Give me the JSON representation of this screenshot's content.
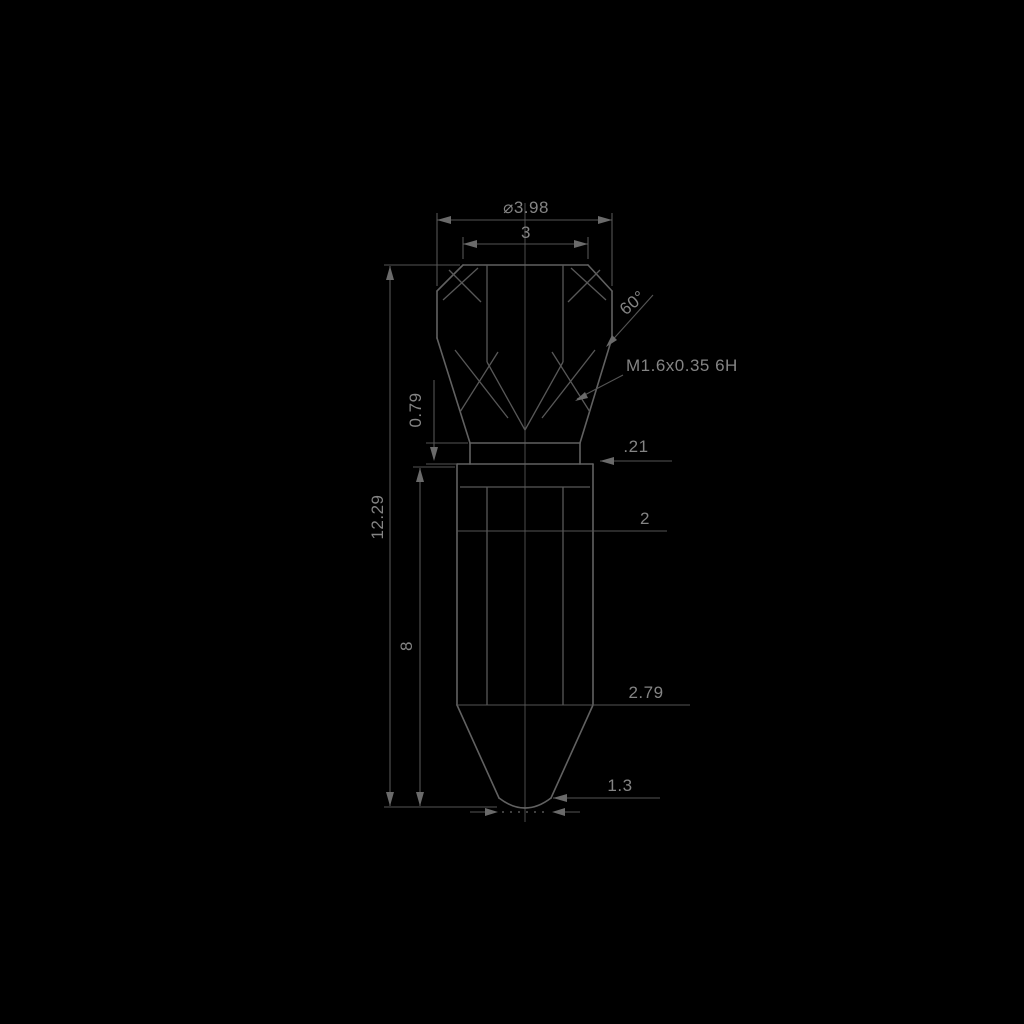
{
  "drawing": {
    "type": "engineering-dimension-drawing",
    "background": "#000000",
    "line_color": "#616161",
    "dimension_line_color": "#555555",
    "text_color": "#848484"
  },
  "labels": {
    "dia_overall": "⌀3.98",
    "width_top": "3",
    "cone_angle": "60°",
    "thread_callout": "M1.6x0.35 6H",
    "neck_length": "0.79",
    "step": ".21",
    "body_dia": "2",
    "overall_length": "12.29",
    "body_length": "8",
    "taper_length": "2.79",
    "tip_dia": "1.3"
  }
}
